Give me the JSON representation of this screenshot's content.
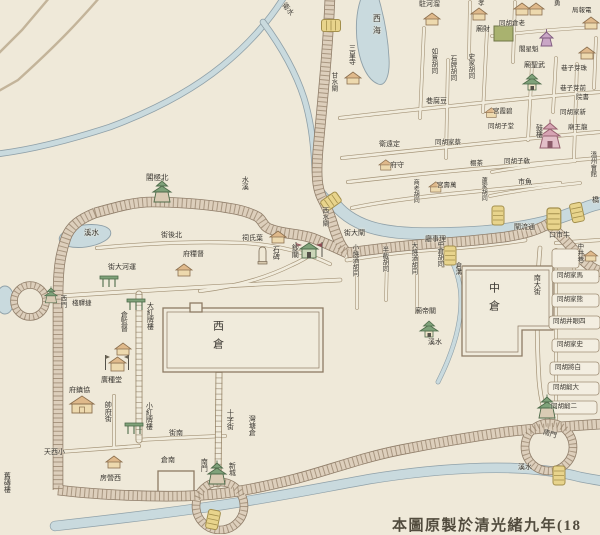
{
  "map": {
    "type": "historical-chinese-city-map",
    "note": "Hand-drawn map of a Qing-dynasty walled canal city with granaries; horizontal labels are written right-to-left, vertical labels top-to-bottom. Bottom caption is cut off by the image edge.",
    "caption": "本圖原製於清光緒九年(18",
    "colors": {
      "paper": "#efe9d9",
      "water": "#c9dade",
      "water_edge": "#8fa0a8",
      "wall": "#ddcfbc",
      "wall_line": "#8e7c68",
      "street_line": "#a39276",
      "building_tan": "#edd9ae",
      "roof_green": "#7fa27a",
      "tower_pink": "#e3bfc8",
      "tower_purple": "#c9a6c6",
      "bridge_yellow": "#e8d48c",
      "green_block": "#a9b26f",
      "text": "#3b3833"
    },
    "labels": [
      {
        "t": "衛水",
        "x": 286,
        "y": 2,
        "r": 52,
        "s": 7
      },
      {
        "t": "閣極北",
        "x": 146,
        "y": 174,
        "s": 7.5
      },
      {
        "t": "水溪",
        "x": 241,
        "y": 176,
        "v": true,
        "s": 7
      },
      {
        "t": "溪水",
        "x": 84,
        "y": 229,
        "s": 7.5
      },
      {
        "t": "街後北",
        "x": 161,
        "y": 232,
        "s": 7
      },
      {
        "t": "祠氏葉",
        "x": 242,
        "y": 235,
        "s": 7
      },
      {
        "t": "石碑",
        "x": 272,
        "y": 246,
        "v": true,
        "s": 7
      },
      {
        "t": "鈔關",
        "x": 291,
        "y": 244,
        "v": true,
        "s": 7
      },
      {
        "t": "西水閘",
        "x": 321,
        "y": 207,
        "v": true,
        "s": 6.5
      },
      {
        "t": "甘水閘",
        "x": 330,
        "y": 72,
        "v": true,
        "s": 6.5
      },
      {
        "t": "西海",
        "x": 372,
        "y": 14,
        "v": true,
        "s": 8,
        "ls": 4
      },
      {
        "t": "三皇寺",
        "x": 348,
        "y": 44,
        "v": true,
        "s": 7
      },
      {
        "t": "街大河運",
        "x": 108,
        "y": 264,
        "s": 7
      },
      {
        "t": "府糧督",
        "x": 183,
        "y": 251,
        "s": 7
      },
      {
        "t": "西門",
        "x": 59,
        "y": 295,
        "v": true,
        "s": 6.5
      },
      {
        "t": "棧驛捷",
        "x": 72,
        "y": 300,
        "s": 6.5
      },
      {
        "t": "倉監督",
        "x": 120,
        "y": 311,
        "v": true,
        "s": 7
      },
      {
        "t": "大紅牌樓",
        "x": 146,
        "y": 302,
        "v": true,
        "s": 7
      },
      {
        "t": "廣種堂",
        "x": 101,
        "y": 377,
        "s": 7
      },
      {
        "t": "府鎮協",
        "x": 69,
        "y": 387,
        "s": 7
      },
      {
        "t": "帥府街",
        "x": 104,
        "y": 401,
        "v": true,
        "s": 7
      },
      {
        "t": "西倉",
        "x": 212,
        "y": 320,
        "v": true,
        "s": 11,
        "ls": 7
      },
      {
        "t": "小紅牌樓",
        "x": 145,
        "y": 402,
        "v": true,
        "s": 7
      },
      {
        "t": "十字街",
        "x": 226,
        "y": 409,
        "v": true,
        "s": 7
      },
      {
        "t": "街南",
        "x": 169,
        "y": 430,
        "s": 7
      },
      {
        "t": "倉南",
        "x": 161,
        "y": 457,
        "s": 7
      },
      {
        "t": "灣塘倉",
        "x": 248,
        "y": 415,
        "v": true,
        "s": 7
      },
      {
        "t": "南門",
        "x": 200,
        "y": 458,
        "v": true,
        "s": 7
      },
      {
        "t": "新城",
        "x": 228,
        "y": 462,
        "v": true,
        "s": 7
      },
      {
        "t": "天西小",
        "x": 44,
        "y": 449,
        "s": 7
      },
      {
        "t": "房營西",
        "x": 100,
        "y": 475,
        "s": 7
      },
      {
        "t": "舊磚樓",
        "x": 3,
        "y": 472,
        "v": true,
        "s": 7
      },
      {
        "t": "街大閘",
        "x": 344,
        "y": 230,
        "s": 7
      },
      {
        "t": "小燒酒胡同",
        "x": 351,
        "y": 244,
        "v": true,
        "s": 6.5
      },
      {
        "t": "半截胡同",
        "x": 381,
        "y": 246,
        "v": true,
        "s": 6.5
      },
      {
        "t": "大燒酒胡同",
        "x": 410,
        "y": 242,
        "v": true,
        "s": 6.5
      },
      {
        "t": "中倉胡同",
        "x": 436,
        "y": 241,
        "v": true,
        "s": 6.5
      },
      {
        "t": "倉溝",
        "x": 454,
        "y": 262,
        "v": true,
        "s": 6.5
      },
      {
        "t": "廳事理",
        "x": 425,
        "y": 236,
        "s": 7
      },
      {
        "t": "廟帝關",
        "x": 415,
        "y": 308,
        "s": 7
      },
      {
        "t": "中倉",
        "x": 488,
        "y": 282,
        "v": true,
        "s": 11,
        "ls": 7
      },
      {
        "t": "南大街",
        "x": 533,
        "y": 274,
        "v": true,
        "s": 7
      },
      {
        "t": "溪水",
        "x": 428,
        "y": 339,
        "s": 7
      },
      {
        "t": "市魚",
        "x": 518,
        "y": 179,
        "s": 7
      },
      {
        "t": "同胡子敎",
        "x": 504,
        "y": 158,
        "s": 6.5
      },
      {
        "t": "口市牛",
        "x": 549,
        "y": 232,
        "s": 7
      },
      {
        "t": "中井巷",
        "x": 576,
        "y": 243,
        "v": true,
        "s": 6.5
      },
      {
        "t": "同胡家馬",
        "x": 557,
        "y": 272,
        "s": 6.5
      },
      {
        "t": "同胡家熊",
        "x": 557,
        "y": 296,
        "s": 6.5
      },
      {
        "t": "同胡井眼四",
        "x": 553,
        "y": 318,
        "s": 6.5
      },
      {
        "t": "同胡家史",
        "x": 557,
        "y": 341,
        "s": 6.5
      },
      {
        "t": "同胡將白",
        "x": 555,
        "y": 364,
        "s": 6.5
      },
      {
        "t": "同胡緞大",
        "x": 553,
        "y": 384,
        "s": 6.5
      },
      {
        "t": "同胡緞二",
        "x": 551,
        "y": 403,
        "s": 6.5
      },
      {
        "t": "南門",
        "x": 544,
        "y": 429,
        "r": 18,
        "s": 7
      },
      {
        "t": "溪水",
        "x": 518,
        "y": 464,
        "s": 7
      },
      {
        "t": "閘流通",
        "x": 514,
        "y": 224,
        "s": 7
      },
      {
        "t": "橋",
        "x": 592,
        "y": 197,
        "s": 7
      },
      {
        "t": "駐河溜",
        "x": 419,
        "y": 1,
        "s": 7
      },
      {
        "t": "孝",
        "x": 478,
        "y": 0,
        "s": 6.5
      },
      {
        "t": "勇",
        "x": 554,
        "y": 0,
        "s": 6.5
      },
      {
        "t": "廟財",
        "x": 476,
        "y": 26,
        "s": 7
      },
      {
        "t": "同胡倉老",
        "x": 499,
        "y": 20,
        "s": 6.5
      },
      {
        "t": "局報電",
        "x": 572,
        "y": 7,
        "s": 6.5
      },
      {
        "t": "如意胡同",
        "x": 430,
        "y": 48,
        "v": true,
        "s": 6.5
      },
      {
        "t": "石牌胡同",
        "x": 449,
        "y": 55,
        "v": true,
        "s": 6.5
      },
      {
        "t": "史家胡同",
        "x": 467,
        "y": 53,
        "v": true,
        "s": 6.5
      },
      {
        "t": "廟聖武",
        "x": 524,
        "y": 62,
        "s": 7
      },
      {
        "t": "閣星魁",
        "x": 519,
        "y": 46,
        "s": 6.5
      },
      {
        "t": "巷子芽珠",
        "x": 561,
        "y": 65,
        "s": 6.5
      },
      {
        "t": "巷子芽前",
        "x": 560,
        "y": 85,
        "s": 6.5
      },
      {
        "t": "院書",
        "x": 576,
        "y": 94,
        "s": 6.5
      },
      {
        "t": "宮霞碧",
        "x": 493,
        "y": 108,
        "s": 6.5
      },
      {
        "t": "同胡家新",
        "x": 560,
        "y": 109,
        "s": 6.5
      },
      {
        "t": "同胡子堂",
        "x": 488,
        "y": 123,
        "s": 6.5
      },
      {
        "t": "鼓樓",
        "x": 535,
        "y": 124,
        "v": true,
        "s": 7
      },
      {
        "t": "廟王龍",
        "x": 568,
        "y": 124,
        "s": 6.5
      },
      {
        "t": "巷腐豆",
        "x": 426,
        "y": 98,
        "s": 7
      },
      {
        "t": "衛遠定",
        "x": 379,
        "y": 141,
        "s": 7
      },
      {
        "t": "同胡家蔡",
        "x": 435,
        "y": 139,
        "s": 6.5
      },
      {
        "t": "府守",
        "x": 390,
        "y": 162,
        "s": 7
      },
      {
        "t": "棚茶",
        "x": 470,
        "y": 160,
        "s": 6.5
      },
      {
        "t": "商老胡同",
        "x": 412,
        "y": 179,
        "v": true,
        "s": 6
      },
      {
        "t": "宮壽萬",
        "x": 437,
        "y": 182,
        "s": 6.5
      },
      {
        "t": "蘆家胡同",
        "x": 480,
        "y": 177,
        "v": true,
        "s": 6
      },
      {
        "t": "溫州會館",
        "x": 589,
        "y": 151,
        "v": true,
        "s": 6.5
      }
    ],
    "markers": [
      {
        "sym": "house",
        "x": 424,
        "y": 12
      },
      {
        "sym": "house",
        "x": 471,
        "y": 7
      },
      {
        "sym": "house",
        "x": 528,
        "y": 2
      },
      {
        "sym": "house",
        "x": 583,
        "y": 16
      },
      {
        "sym": "house",
        "x": 579,
        "y": 46
      },
      {
        "sym": "house",
        "x": 514,
        "y": 2
      },
      {
        "sym": "house",
        "x": 345,
        "y": 71
      },
      {
        "sym": "house",
        "x": 270,
        "y": 230
      },
      {
        "sym": "house",
        "x": 176,
        "y": 263
      },
      {
        "sym": "house",
        "x": 115,
        "y": 342
      },
      {
        "sym": "bighouse",
        "x": 70,
        "y": 395
      },
      {
        "sym": "house",
        "x": 106,
        "y": 455
      },
      {
        "sym": "house",
        "x": 429,
        "y": 181,
        "sc": 0.85
      },
      {
        "sym": "house",
        "x": 379,
        "y": 159,
        "sc": 0.85
      },
      {
        "sym": "house",
        "x": 584,
        "y": 250,
        "sc": 0.85
      },
      {
        "sym": "house",
        "x": 485,
        "y": 107,
        "sc": 0.8
      },
      {
        "sym": "greensq",
        "x": 494,
        "y": 26
      },
      {
        "sym": "temple",
        "x": 523,
        "y": 71
      },
      {
        "sym": "temple",
        "x": 420,
        "y": 318
      },
      {
        "sym": "tower-purple",
        "x": 539,
        "y": 28
      },
      {
        "sym": "tower-pink",
        "x": 538,
        "y": 116
      },
      {
        "sym": "tower-green",
        "x": 152,
        "y": 178
      },
      {
        "sym": "tower-green",
        "x": 207,
        "y": 460
      },
      {
        "sym": "tower-green",
        "x": 537,
        "y": 394
      },
      {
        "sym": "tower-green",
        "x": 44,
        "y": 286,
        "sc": 0.7
      },
      {
        "sym": "stele",
        "x": 258,
        "y": 246
      },
      {
        "sym": "arch",
        "x": 127,
        "y": 297
      },
      {
        "sym": "arch",
        "x": 125,
        "y": 421
      },
      {
        "sym": "arch",
        "x": 100,
        "y": 274
      },
      {
        "sym": "flaghouse",
        "x": 294,
        "y": 240
      },
      {
        "sym": "flagpair",
        "x": 104,
        "y": 353
      },
      {
        "sym": "bridge",
        "x": 325,
        "y": 192,
        "r": 55
      },
      {
        "sym": "bridge",
        "x": 325,
        "y": 16,
        "r": 90
      },
      {
        "sym": "bridge",
        "x": 492,
        "y": 206
      },
      {
        "sym": "bridge",
        "x": 547,
        "y": 208,
        "sc": 1.15
      },
      {
        "sym": "bridge",
        "x": 571,
        "y": 203,
        "r": -12
      },
      {
        "sym": "bridge",
        "x": 444,
        "y": 246
      },
      {
        "sym": "bridge",
        "x": 553,
        "y": 466
      },
      {
        "sym": "bridge",
        "x": 207,
        "y": 510,
        "r": 12
      }
    ]
  }
}
